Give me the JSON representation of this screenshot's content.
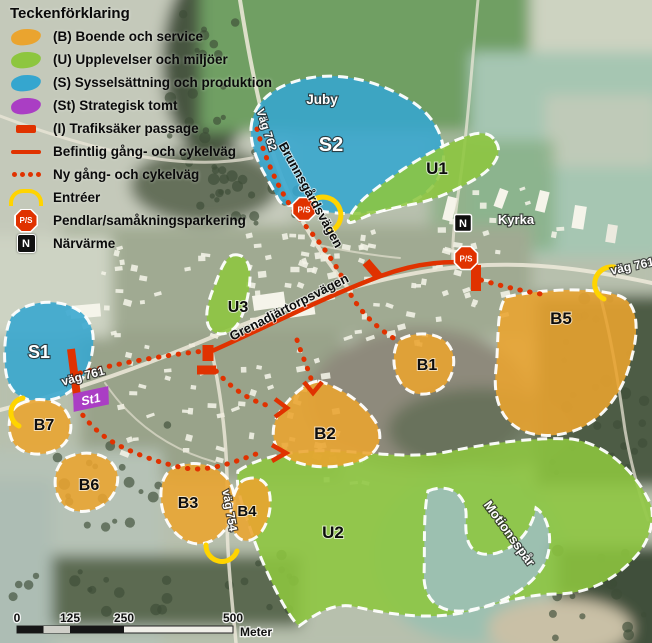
{
  "legend": {
    "title": "Teckenförklaring",
    "items": [
      {
        "label": "(B) Boende och service"
      },
      {
        "label": "(U) Upplevelser och miljöer"
      },
      {
        "label": "(S) Sysselsättning och produktion"
      },
      {
        "label": "(St) Strategisk tomt"
      },
      {
        "label": "(I) Trafiksäker passage"
      },
      {
        "label": "Befintlig gång- och cykelväg"
      },
      {
        "label": "Ny gång- och cykelväg"
      },
      {
        "label": "Entréer"
      },
      {
        "label": "Pendlar/samåkningsparkering"
      },
      {
        "label": "Närvärme"
      }
    ]
  },
  "zones": {
    "s1": "S1",
    "s2": "S2",
    "u1": "U1",
    "u2": "U2",
    "u3": "U3",
    "b1": "B1",
    "b2": "B2",
    "b3": "B3",
    "b4": "B4",
    "b5": "B5",
    "b6": "B6",
    "b7": "B7"
  },
  "places": {
    "juby": "Juby",
    "kyrka": "Kyrka",
    "motionsspar": "Motionsspår"
  },
  "roads": {
    "vag761_left": "väg 761",
    "vag761_right": "väg 761",
    "vag762": "Väg 762",
    "vag754": "väg 754",
    "brunnsgardsvagen": "Brunnsgårdsvägen",
    "grenadjartorpsvagen": "Grenadjärtorpsvägen"
  },
  "markers": {
    "ps": "P/S",
    "n": "N",
    "st1": "St1"
  },
  "scalebar": {
    "t0": "0",
    "t125": "125",
    "t250": "250",
    "t500": "500",
    "unit": "Meter"
  },
  "colors": {
    "boende_orange": "#EAA42F",
    "upplevelser_green": "#8DC63F",
    "sysselsattning_blue": "#35A6CF",
    "strategisk_purple": "#AA3EC4",
    "marking_red": "#E03200",
    "entre_yellow": "#FFD400"
  }
}
